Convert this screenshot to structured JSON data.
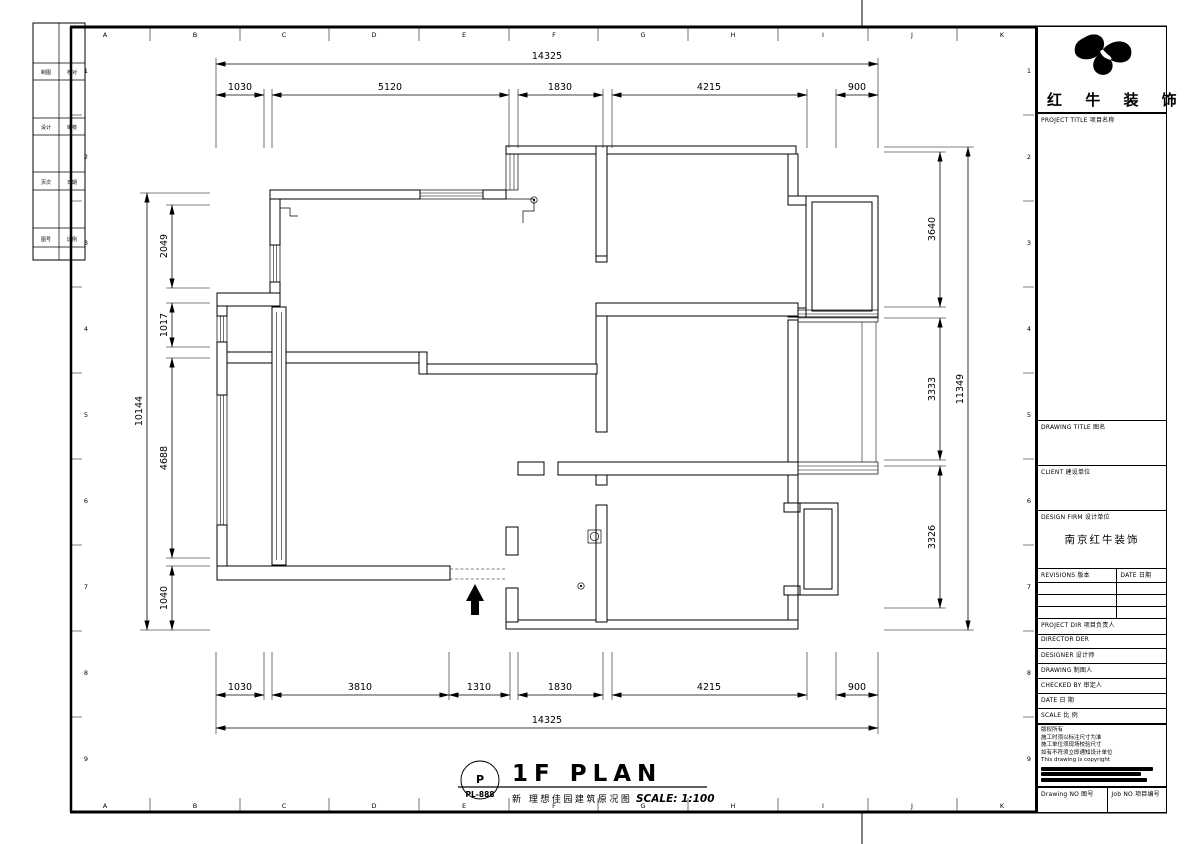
{
  "sheet": {
    "grid_letters": [
      "A",
      "B",
      "C",
      "D",
      "E",
      "F",
      "G",
      "H",
      "I",
      "J",
      "K"
    ],
    "row_numbers": [
      "1",
      "2",
      "3",
      "4",
      "5",
      "6",
      "7",
      "8",
      "9"
    ]
  },
  "mini_table": {
    "rows": [
      [
        "制图",
        "校对"
      ],
      [
        "设计",
        "审核"
      ],
      [
        "页次",
        "日期"
      ],
      [
        "图号",
        "比例"
      ]
    ]
  },
  "dims": {
    "top": {
      "overall": "14325",
      "segments": [
        "1030",
        "5120",
        "1830",
        "4215",
        "900"
      ]
    },
    "bottom": {
      "overall": "14325",
      "segments": [
        "1030",
        "3810",
        "1310",
        "1830",
        "4215",
        "900"
      ]
    },
    "left": {
      "overall": "10144",
      "segments": [
        "2049",
        "1017",
        "4688",
        "1040"
      ]
    },
    "right": {
      "overall": "11349",
      "segments": [
        "3640",
        "3333",
        "3326"
      ]
    }
  },
  "footer": {
    "stamp_letter": "P",
    "stamp_code": "PL-888",
    "plan_title": "1F PLAN",
    "subtitle": "新 理想佳园建筑原况图",
    "scale": "SCALE: 1:100"
  },
  "titleblock": {
    "company": "红 牛 装 饰",
    "project_title_label": "PROJECT TITLE 项目名称",
    "drawing_title_label": "DRAWING TITLE 图名",
    "client_label": "CLIENT 建设单位",
    "design_firm_label": "DESIGN FIRM 设计单位",
    "design_firm_value": "南京红牛装饰",
    "revisions_label": "REVISIONS 版本",
    "revisions_date_label": "DATE 日期",
    "project_dir_label": "PROJECT DIR 项目负责人",
    "director_label": "DIRECTOR DER",
    "designer_label": "DESIGNER 设计师",
    "drawing_by_label": "DRAWING 制图人",
    "checked_by_label": "CHECKED BY 审定人",
    "date_label": "DATE 日 期",
    "scale_label": "SCALE 比 例",
    "copyright_lines": [
      "版权所有",
      "施工时须以标注尺寸为准",
      "施工单位须现场校验尺寸",
      "如有不符须立即通知设计单位",
      "This drawing is copyright"
    ],
    "drawing_no_label": "Drawing NO 图号",
    "job_no_label": "Job NO 项目编号"
  }
}
